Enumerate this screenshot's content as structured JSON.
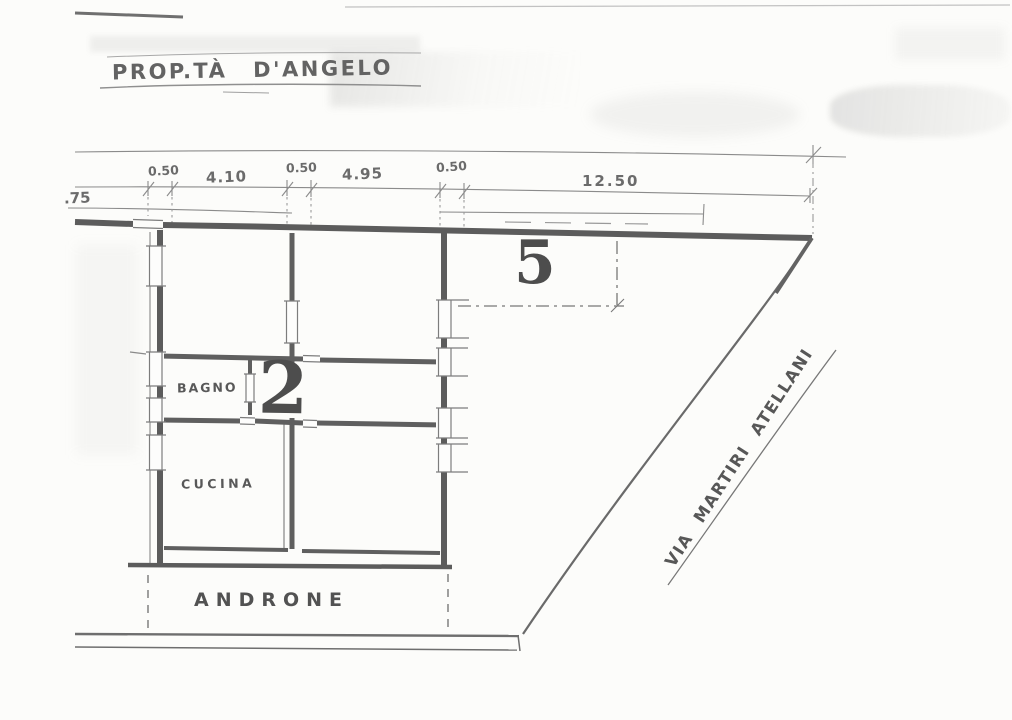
{
  "plan": {
    "title": "PROP.TÀ D'ANGELO",
    "street_name": "VIA MARTIRI ATELLANI",
    "dimensions": [
      {
        "id": "left-offset",
        "text": ".75"
      },
      {
        "id": "wall-a",
        "text": "0.50"
      },
      {
        "id": "span-a",
        "text": "4.10"
      },
      {
        "id": "wall-b",
        "text": "0.50"
      },
      {
        "id": "span-b",
        "text": "4.95"
      },
      {
        "id": "wall-c",
        "text": "0.50"
      },
      {
        "id": "span-street",
        "text": "12.50"
      }
    ],
    "rooms": [
      {
        "id": "bagno",
        "label": "BAGNO"
      },
      {
        "id": "cucina",
        "label": "CUCINA"
      },
      {
        "id": "androne",
        "label": "ANDRONE"
      }
    ],
    "units": [
      {
        "id": "unit-2",
        "number": "2"
      },
      {
        "id": "unit-5",
        "number": "5"
      }
    ],
    "colors": {
      "paper": "#fcfcfa",
      "pencil": "#8b8b8b",
      "wall": "#5c5c5c",
      "digit": "#4d4d4d"
    }
  }
}
